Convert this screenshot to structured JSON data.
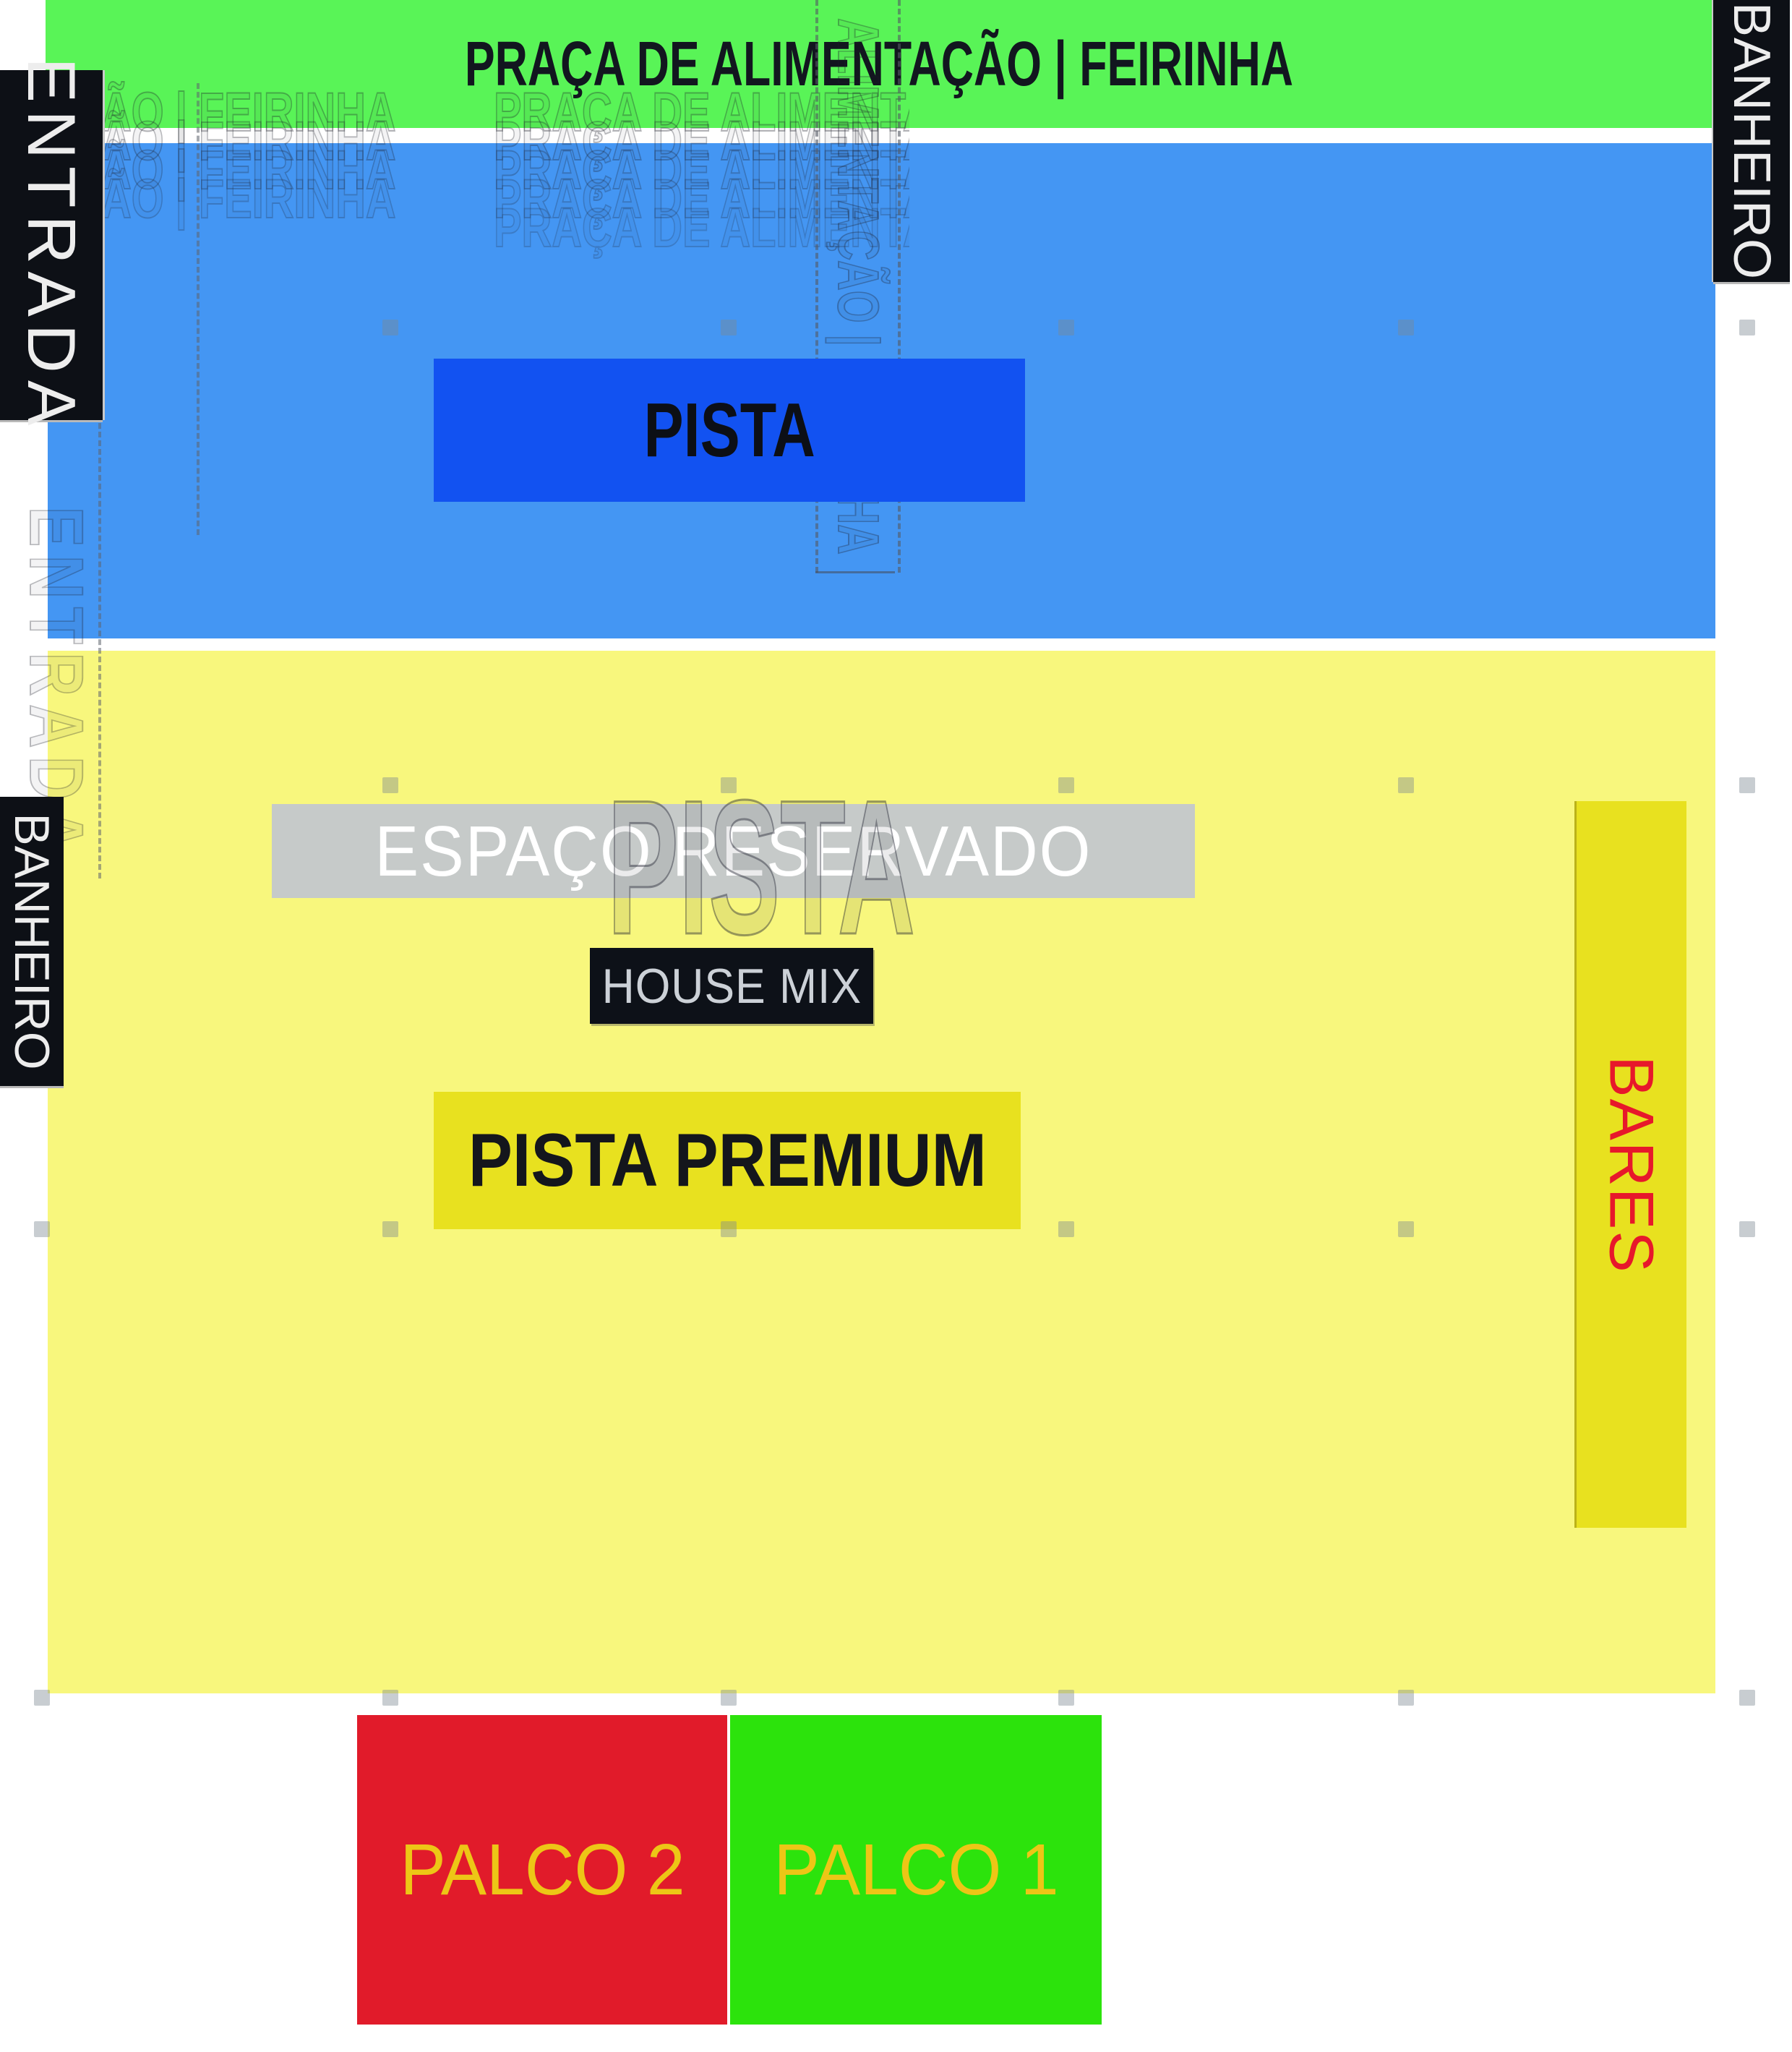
{
  "title": {
    "text": "PRAÇA DE ALIMENTAÇÃO | FEIRINHA"
  },
  "zones": {
    "entrada": {
      "label": "ENTRADA"
    },
    "banheiro_top_right": {
      "label": "BANHEIRO"
    },
    "banheiro_left": {
      "label": "BANHEIRO"
    },
    "pista": {
      "label": "PISTA"
    },
    "espaco_reservado": {
      "label": "ESPAÇO RESERVADO"
    },
    "house_mix": {
      "label": "HOUSE MIX"
    },
    "pista_premium": {
      "label": "PISTA PREMIUM"
    },
    "bares": {
      "label": "BARES"
    },
    "palco_2": {
      "label": "PALCO 2"
    },
    "palco_1": {
      "label": "PALCO 1"
    }
  },
  "ghost_artifacts": {
    "title_tail": "ÃO | FEIRINHA",
    "title_head": "PRAÇA DE ALIMENTAÇÃO",
    "vertical_title": "ALIMENTAÇÃO | FEIRINHA",
    "vertical_entrada": "ENTRADA",
    "pista": "PISTA"
  },
  "colors": {
    "food_court_green": "#59f457",
    "pista_area_blue": "#4496f3",
    "pista_box_blue": "#1252f1",
    "premium_area_yellow": "#f8f77d",
    "accent_yellow": "#e8e11f",
    "reserved_gray": "#c6cac9",
    "black_bar": "#0d1016",
    "title_text": "#12161f",
    "bares_text_red": "#e7182b",
    "palco2_red": "#e11b2a",
    "palco1_green": "#2ce30c",
    "palco_label_gold": "#edc616"
  }
}
